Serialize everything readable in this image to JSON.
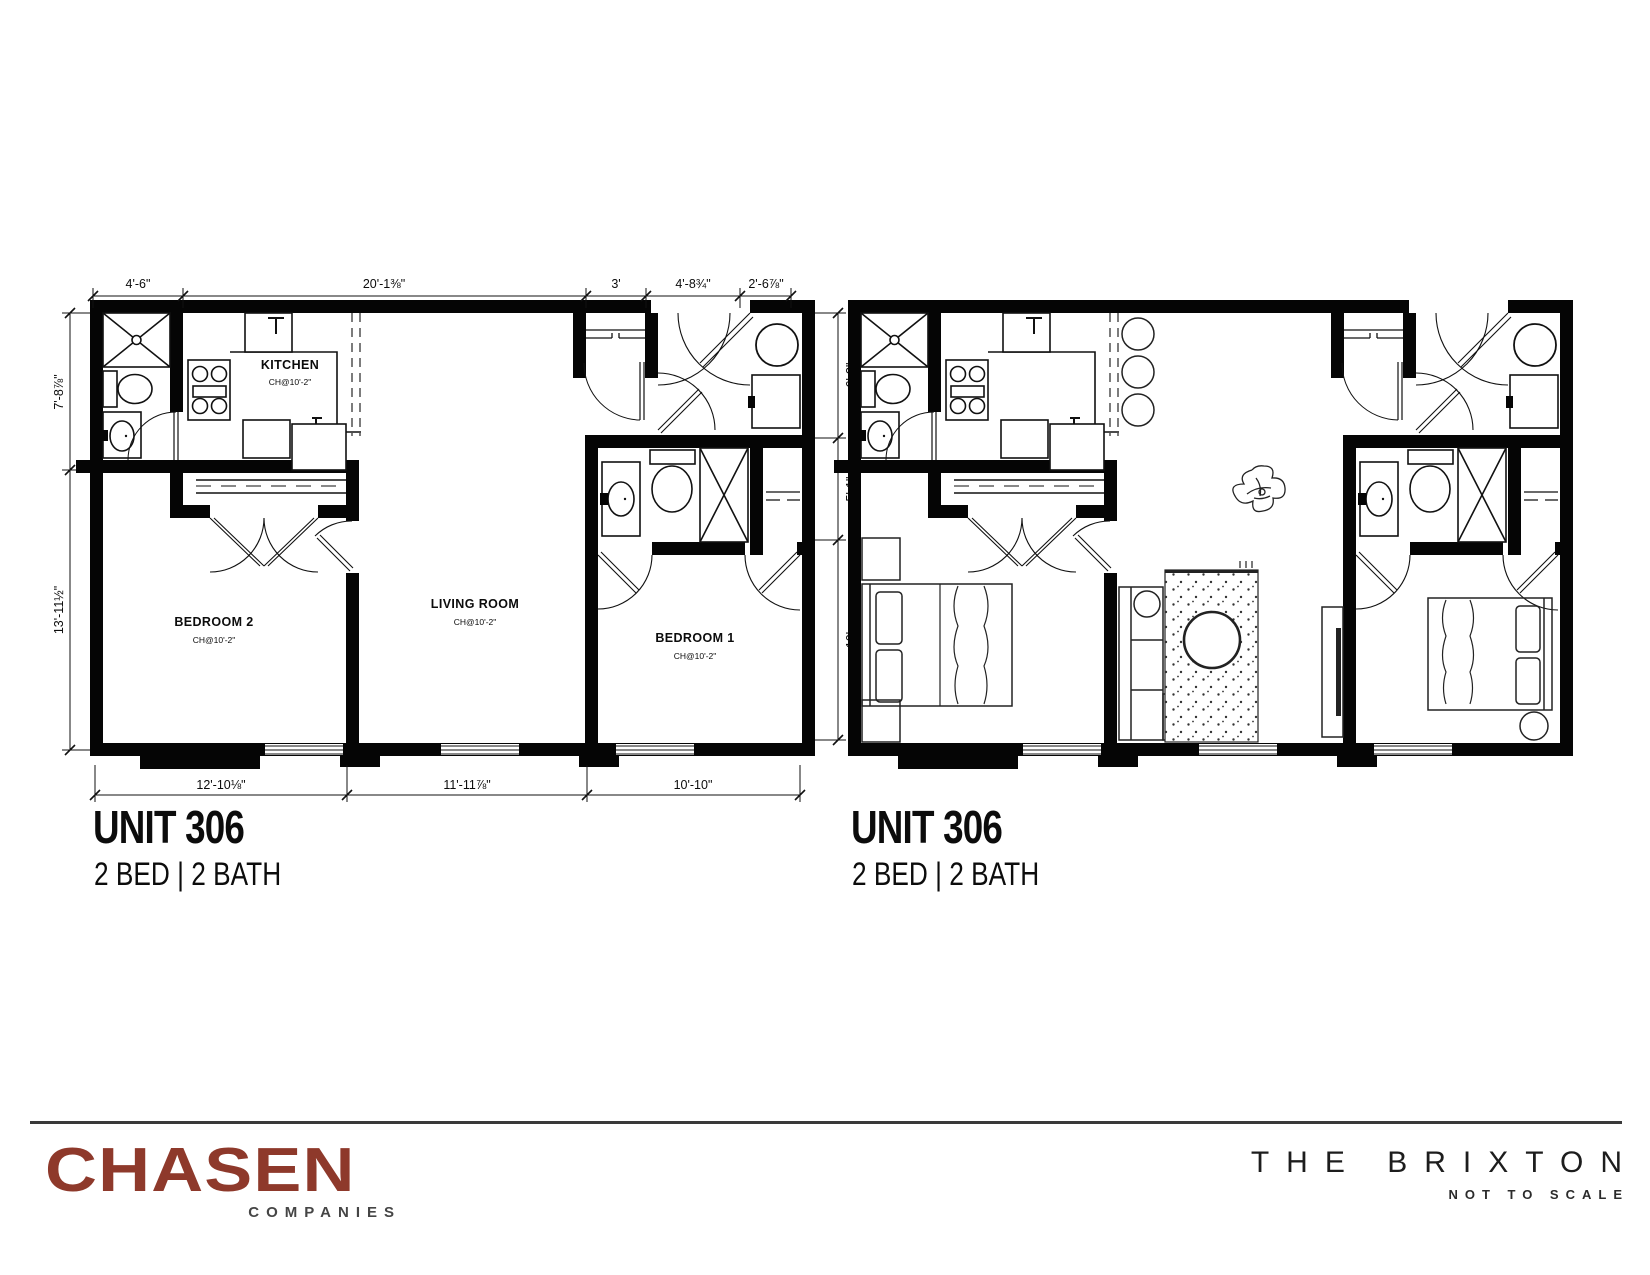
{
  "plans": {
    "left": {
      "title": "UNIT 306",
      "subtitle": "2 BED | 2 BATH",
      "rooms": {
        "kitchen": {
          "name": "KITCHEN",
          "ceiling": "CH@10'-2\""
        },
        "living": {
          "name": "LIVING ROOM",
          "ceiling": "CH@10'-2\""
        },
        "bedroom1": {
          "name": "BEDROOM 1",
          "ceiling": "CH@10'-2\""
        },
        "bedroom2": {
          "name": "BEDROOM 2",
          "ceiling": "CH@10'-2\""
        }
      },
      "dims": {
        "top": [
          "4'-6\"",
          "20'-1⅜\"",
          "3'",
          "4'-8¾\"",
          "2'-6⅞\""
        ],
        "left": [
          "7'-8⅞\"",
          "13'-11½\""
        ],
        "right": [
          "6'-3\"",
          "5'-1\"",
          "10'"
        ],
        "bottom": [
          "12'-10⅛\"",
          "11'-11⅞\"",
          "10'-10\""
        ]
      }
    },
    "right": {
      "title": "UNIT 306",
      "subtitle": "2 BED | 2 BATH"
    }
  },
  "footer": {
    "logo": "CHASEN",
    "logo_sub": "COMPANIES",
    "brand": "THE BRIXTON",
    "scale_note": "NOT TO SCALE"
  },
  "colors": {
    "logo": "#8e392b",
    "divider_line": "#3a3a3a",
    "ink": "#0c0c0c"
  }
}
